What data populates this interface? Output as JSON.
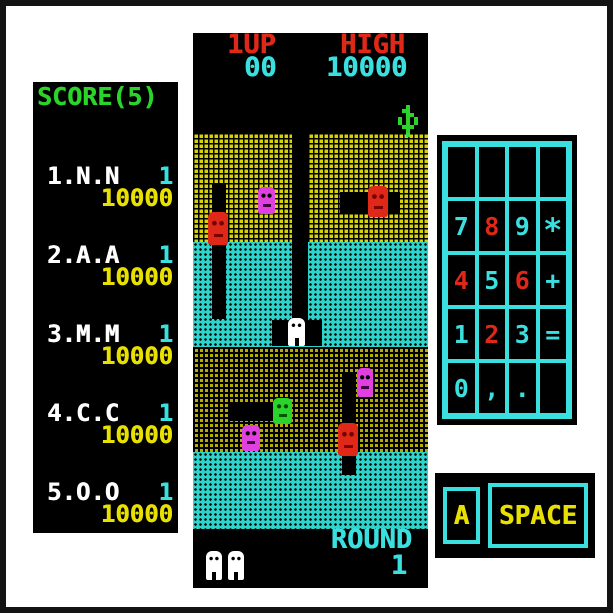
{
  "colors": {
    "red": "#e02818",
    "cyan": "#3ae0e0",
    "yellow": "#e8e000",
    "green": "#2ad42a",
    "magenta": "#e040e0",
    "white": "#ffffff",
    "dirt_top": "#d8d400",
    "dirt_bottom": "#b4ac00",
    "water": "#2cd4cc"
  },
  "scoreboard": {
    "title": "SCORE(5)",
    "entries": [
      {
        "name": "1.N.N",
        "flag": "1",
        "score": "10000"
      },
      {
        "name": "2.A.A",
        "flag": "1",
        "score": "10000"
      },
      {
        "name": "3.M.M",
        "flag": "1",
        "score": "10000"
      },
      {
        "name": "4.C.C",
        "flag": "1",
        "score": "10000"
      },
      {
        "name": "5.O.O",
        "flag": "1",
        "score": "10000"
      }
    ]
  },
  "hud": {
    "p1_label": "1UP",
    "p1_score": "00",
    "high_label": "HIGH",
    "high_score": "10000",
    "round_label": "ROUND",
    "round_value": "1"
  },
  "keypad": {
    "rows": [
      [
        "",
        "",
        "",
        ""
      ],
      [
        "7",
        "8",
        "9",
        "*"
      ],
      [
        "4",
        "5",
        "6",
        "+"
      ],
      [
        "1",
        "2",
        "3",
        "="
      ],
      [
        "0",
        ",",
        ".",
        ""
      ]
    ]
  },
  "buttons": {
    "a_label": "A",
    "space_label": "SPACE"
  }
}
